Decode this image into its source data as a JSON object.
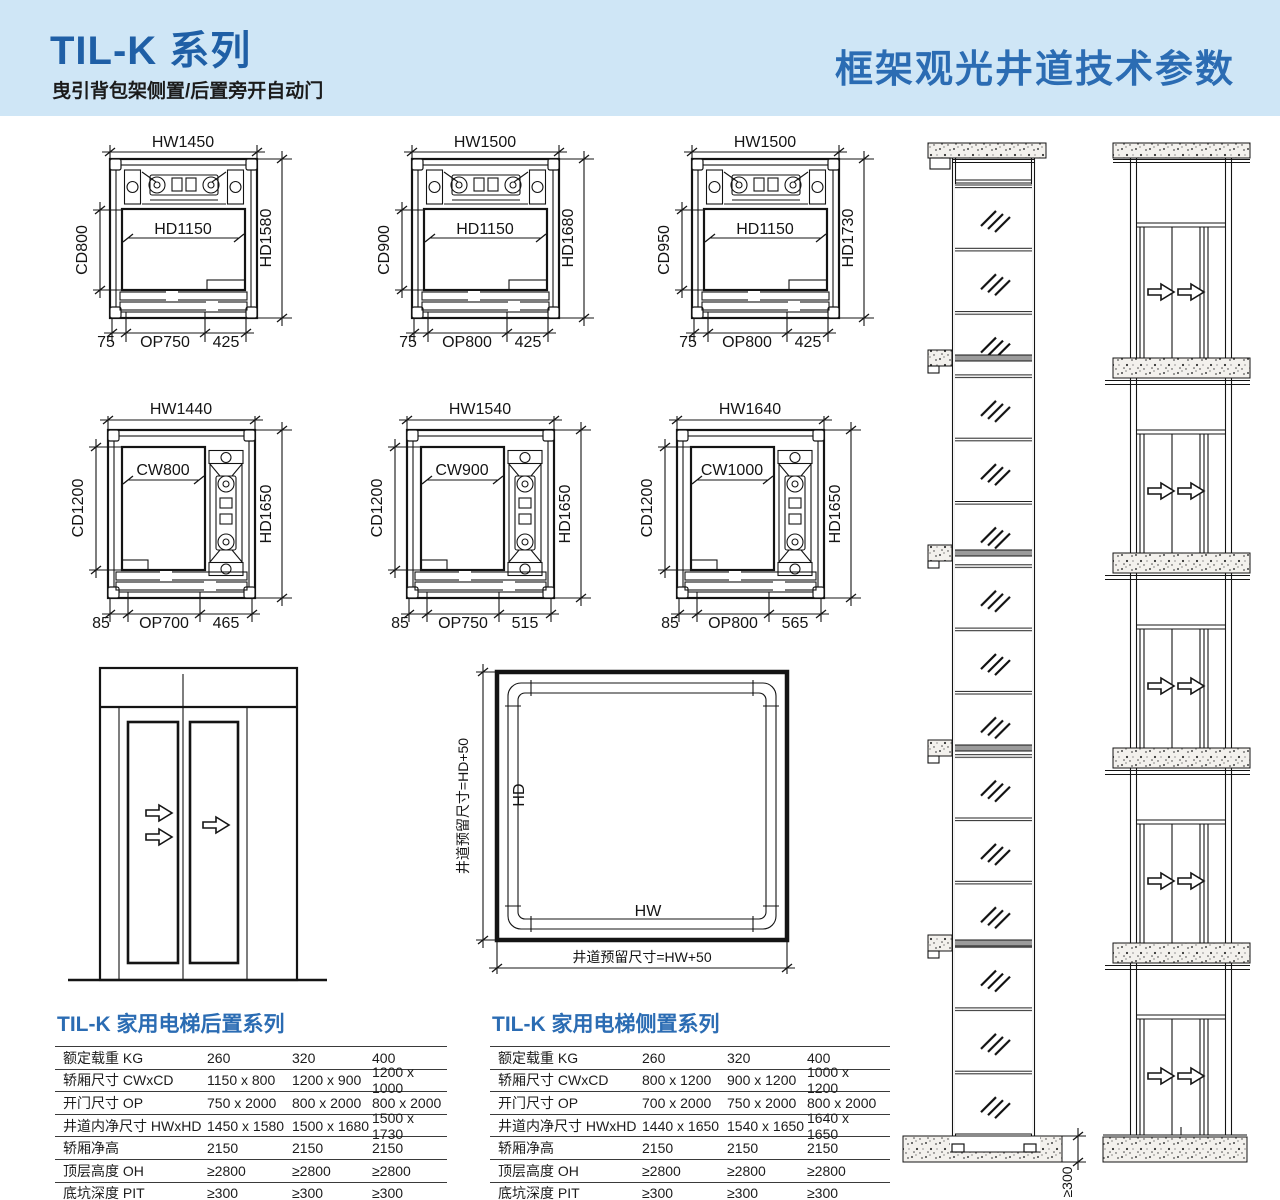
{
  "header": {
    "title": "TIL-K 系列",
    "subtitle": "曳引背包架侧置/后置旁开自动门",
    "right_title": "框架观光井道技术参数"
  },
  "cross_sections": [
    {
      "hw": "HW1450",
      "inner": "HD1150",
      "cd": "CD800",
      "hd": "HD1580",
      "d0": "75",
      "d1": "OP750",
      "d2": "425"
    },
    {
      "hw": "HW1500",
      "inner": "HD1150",
      "cd": "CD900",
      "hd": "HD1680",
      "d0": "75",
      "d1": "OP800",
      "d2": "425"
    },
    {
      "hw": "HW1500",
      "inner": "HD1150",
      "cd": "CD950",
      "hd": "HD1730",
      "d0": "75",
      "d1": "OP800",
      "d2": "425"
    },
    {
      "hw": "HW1440",
      "inner": "CW800",
      "cd": "CD1200",
      "hd": "HD1650",
      "d0": "85",
      "d1": "OP700",
      "d2": "465"
    },
    {
      "hw": "HW1540",
      "inner": "CW900",
      "cd": "CD1200",
      "hd": "HD1650",
      "d0": "85",
      "d1": "OP750",
      "d2": "515"
    },
    {
      "hw": "HW1640",
      "inner": "CW1000",
      "cd": "CD1200",
      "hd": "HD1650",
      "d0": "85",
      "d1": "OP800",
      "d2": "565"
    }
  ],
  "shaft_plan": {
    "hd_label": "HD",
    "hw_label": "HW",
    "left_dim": "井道预留尺寸=HD+50",
    "bottom_dim": "井道预留尺寸=HW+50"
  },
  "shaft_elevation": {
    "pit_dim": "≥300"
  },
  "tables": [
    {
      "title": "TIL-K 家用电梯后置系列",
      "rows": [
        {
          "label": "额定载重 KG",
          "v1": "260",
          "v2": "320",
          "v3": "400"
        },
        {
          "label": "轿厢尺寸 CWxCD",
          "v1": "1150 x 800",
          "v2": "1200 x 900",
          "v3": "1200 x 1000"
        },
        {
          "label": "开门尺寸 OP",
          "v1": "750 x 2000",
          "v2": "800 x 2000",
          "v3": "800 x 2000"
        },
        {
          "label": "井道内净尺寸 HWxHD",
          "v1": "1450 x 1580",
          "v2": "1500 x 1680",
          "v3": "1500 x 1730"
        },
        {
          "label": "轿厢净高",
          "v1": "2150",
          "v2": "2150",
          "v3": "2150"
        },
        {
          "label": "顶层高度 OH",
          "v1": "≥2800",
          "v2": "≥2800",
          "v3": "≥2800"
        },
        {
          "label": "底坑深度 PIT",
          "v1": "≥300",
          "v2": "≥300",
          "v3": "≥300"
        }
      ]
    },
    {
      "title": "TIL-K 家用电梯侧置系列",
      "rows": [
        {
          "label": "额定载重 KG",
          "v1": "260",
          "v2": "320",
          "v3": "400"
        },
        {
          "label": "轿厢尺寸 CWxCD",
          "v1": "800 x 1200",
          "v2": "900 x 1200",
          "v3": "1000 x 1200"
        },
        {
          "label": "开门尺寸 OP",
          "v1": "700 x 2000",
          "v2": "750 x 2000",
          "v3": "800 x 2000"
        },
        {
          "label": "井道内净尺寸 HWxHD",
          "v1": "1440 x 1650",
          "v2": "1540 x 1650",
          "v3": "1640 x 1650"
        },
        {
          "label": "轿厢净高",
          "v1": "2150",
          "v2": "2150",
          "v3": "2150"
        },
        {
          "label": "顶层高度 OH",
          "v1": "≥2800",
          "v2": "≥2800",
          "v3": "≥2800"
        },
        {
          "label": "底坑深度 PIT",
          "v1": "≥300",
          "v2": "≥300",
          "v3": "≥300"
        }
      ]
    }
  ],
  "colors": {
    "header_bg": "#cfe6f6",
    "accent": "#2b6cb3",
    "line": "#141414"
  }
}
